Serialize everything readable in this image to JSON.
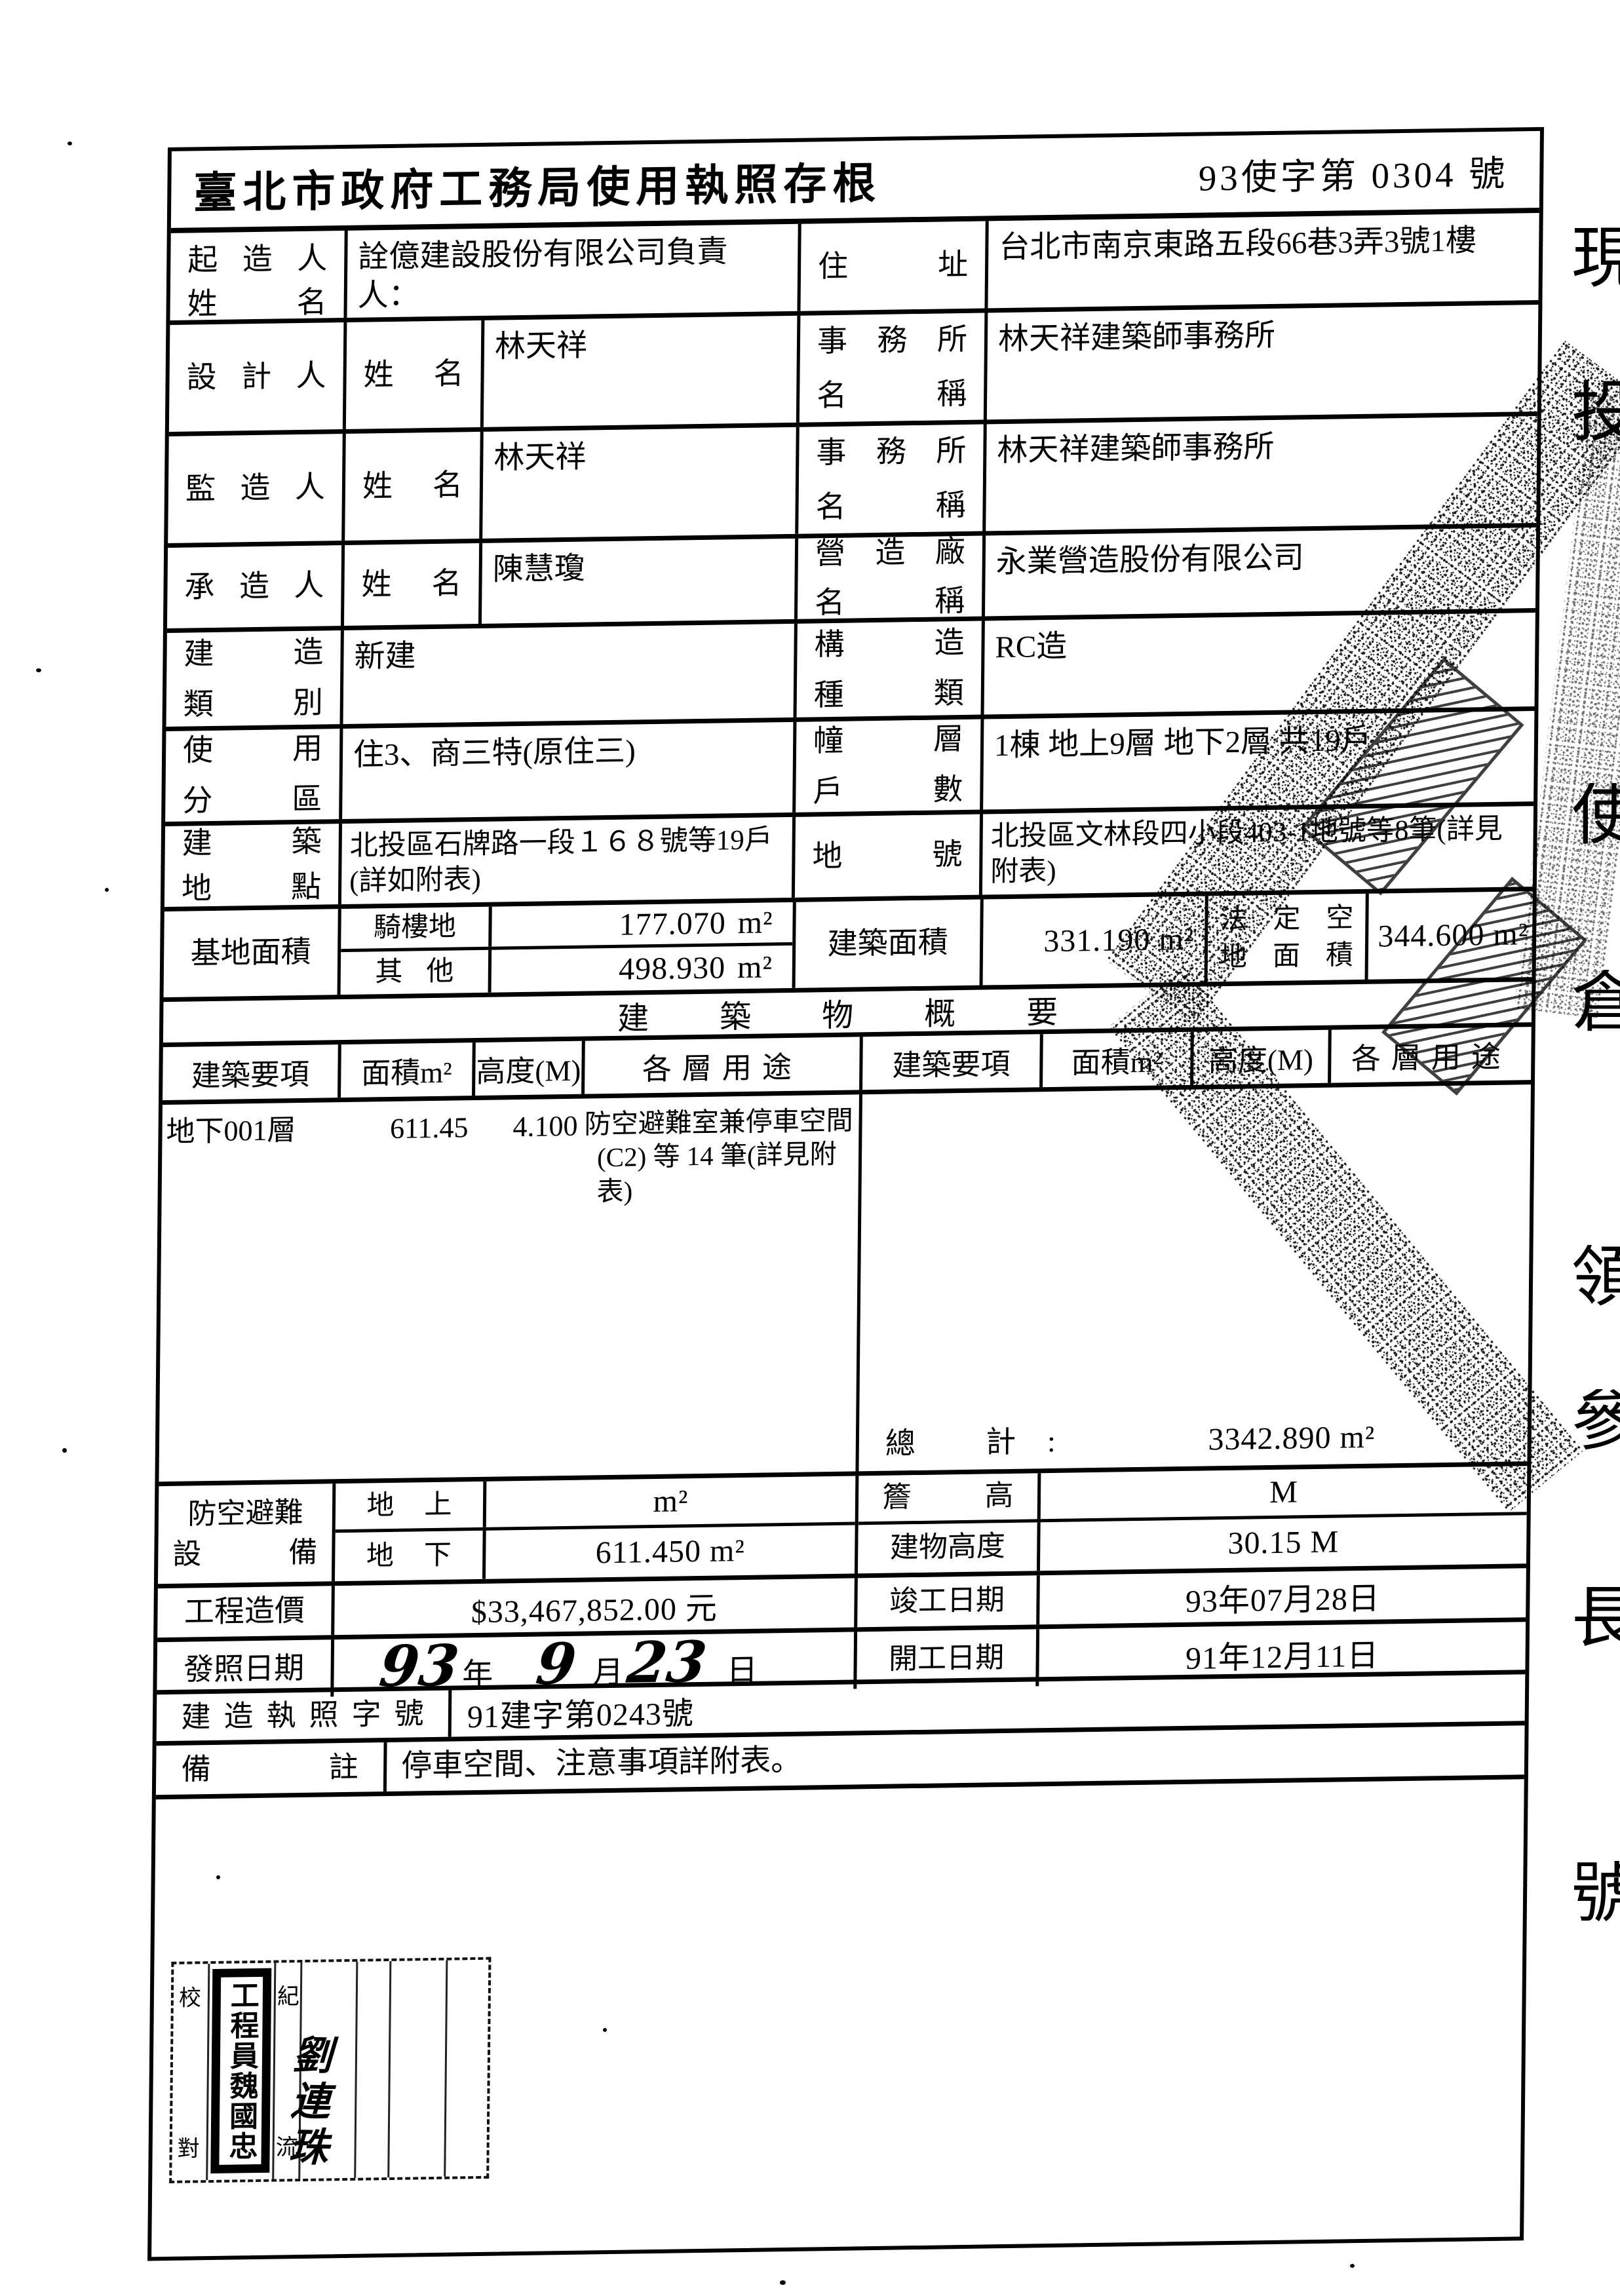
{
  "title": "臺北市政府工務局使用執照存根",
  "doc_no": "93使字第 0304 號",
  "owner": {
    "label1": "起 造 人",
    "label2": "姓 名",
    "value1": "詮億建設股份有限公司負責人：",
    "value2": "林添裕",
    "addr_label": "住 址",
    "addr": "台北市南京東路五段66巷3弄3號1樓"
  },
  "designer": {
    "label": "設 計 人",
    "sub": "姓 名",
    "name": "林天祥",
    "office_label1": "事 務 所",
    "office_label2": "名 稱",
    "office": "林天祥建築師事務所"
  },
  "supervisor": {
    "label": "監 造 人",
    "sub": "姓 名",
    "name": "林天祥",
    "office_label1": "事 務 所",
    "office_label2": "名 稱",
    "office": "林天祥建築師事務所"
  },
  "contractor": {
    "label": "承 造 人",
    "sub": "姓 名",
    "name": "陳慧瓊",
    "office_label1": "營 造 廠",
    "office_label2": "名 稱",
    "office": "永業營造股份有限公司"
  },
  "build_class": {
    "label1": "建 造",
    "label2": "類 別",
    "value": "新建",
    "rlabel1": "構 造",
    "rlabel2": "種 類",
    "rvalue": "RC造"
  },
  "zoning": {
    "label1": "使 用",
    "label2": "分 區",
    "value": "住3、商三特(原住三)",
    "rlabel1": "幢 層",
    "rlabel2": "戶 數",
    "rvalue": "1棟 地上9層 地下2層 共19戶"
  },
  "site": {
    "label1": "建 築",
    "label2": "地 點",
    "value": "北投區石牌路一段１６８號等19戶(詳如附表)",
    "rlabel": "地 號",
    "rvalue": "北投區文林段四小段403-1地號等8筆(詳見附表)"
  },
  "base_area": {
    "label": "基地面積",
    "sub1": "騎樓地",
    "v1": "177.070",
    "u1": "m²",
    "sub2": "其 他",
    "v2": "498.930",
    "u2": "m²",
    "bld_label": "建築面積",
    "bld_value": "331.190 m²",
    "legal1": "法 定 空",
    "legal2": "地 面 積",
    "legal_value": "344.600 m²"
  },
  "overview": {
    "band": "建　築　物　概　要",
    "h_item": "建築要項",
    "h_area": "面積m²",
    "h_height": "高度(M)",
    "h_use": "各層用途",
    "floor": "地下001層",
    "area": "611.45",
    "height": "4.100",
    "use1": "防空避難室兼停車空間",
    "use2": "(C2) 等 14 筆(詳見附表)",
    "total_label": "總 計:",
    "total": "3342.890 m²"
  },
  "shelter": {
    "label1": "防空避難",
    "label2": "設 備",
    "sub_up": "地 上",
    "up_value": "m²",
    "sub_down": "地 下",
    "down_value": "611.450 m²"
  },
  "eave": {
    "label": "簷 高",
    "value": "M"
  },
  "bld_height": {
    "label": "建物高度",
    "value": "30.15 M"
  },
  "cost": {
    "label": "工程造價",
    "value": "$33,467,852.00 元"
  },
  "complete_date": {
    "label": "竣工日期",
    "value": "93年07月28日"
  },
  "issue_date": {
    "label": "發照日期",
    "year": "93",
    "y_unit": "年",
    "month": "9",
    "m_unit": "月",
    "day": "23",
    "d_unit": "日"
  },
  "start_date": {
    "label": "開工日期",
    "value": "91年12月11日"
  },
  "permit": {
    "label": "建造執照字號",
    "value": "91建字第0243號"
  },
  "remark": {
    "label": "備 註",
    "value": "停車空間、注意事項詳附表。"
  },
  "stamp_block": {
    "check_top": "校",
    "check_bottom": "對",
    "seal": "工程員魏國忠",
    "num_top": "紀",
    "num_bottom": "流",
    "signature": "劉連珠"
  },
  "edge_fragments": [
    "現",
    "投",
    "使",
    "倉",
    "領",
    "參",
    "長",
    "號"
  ]
}
